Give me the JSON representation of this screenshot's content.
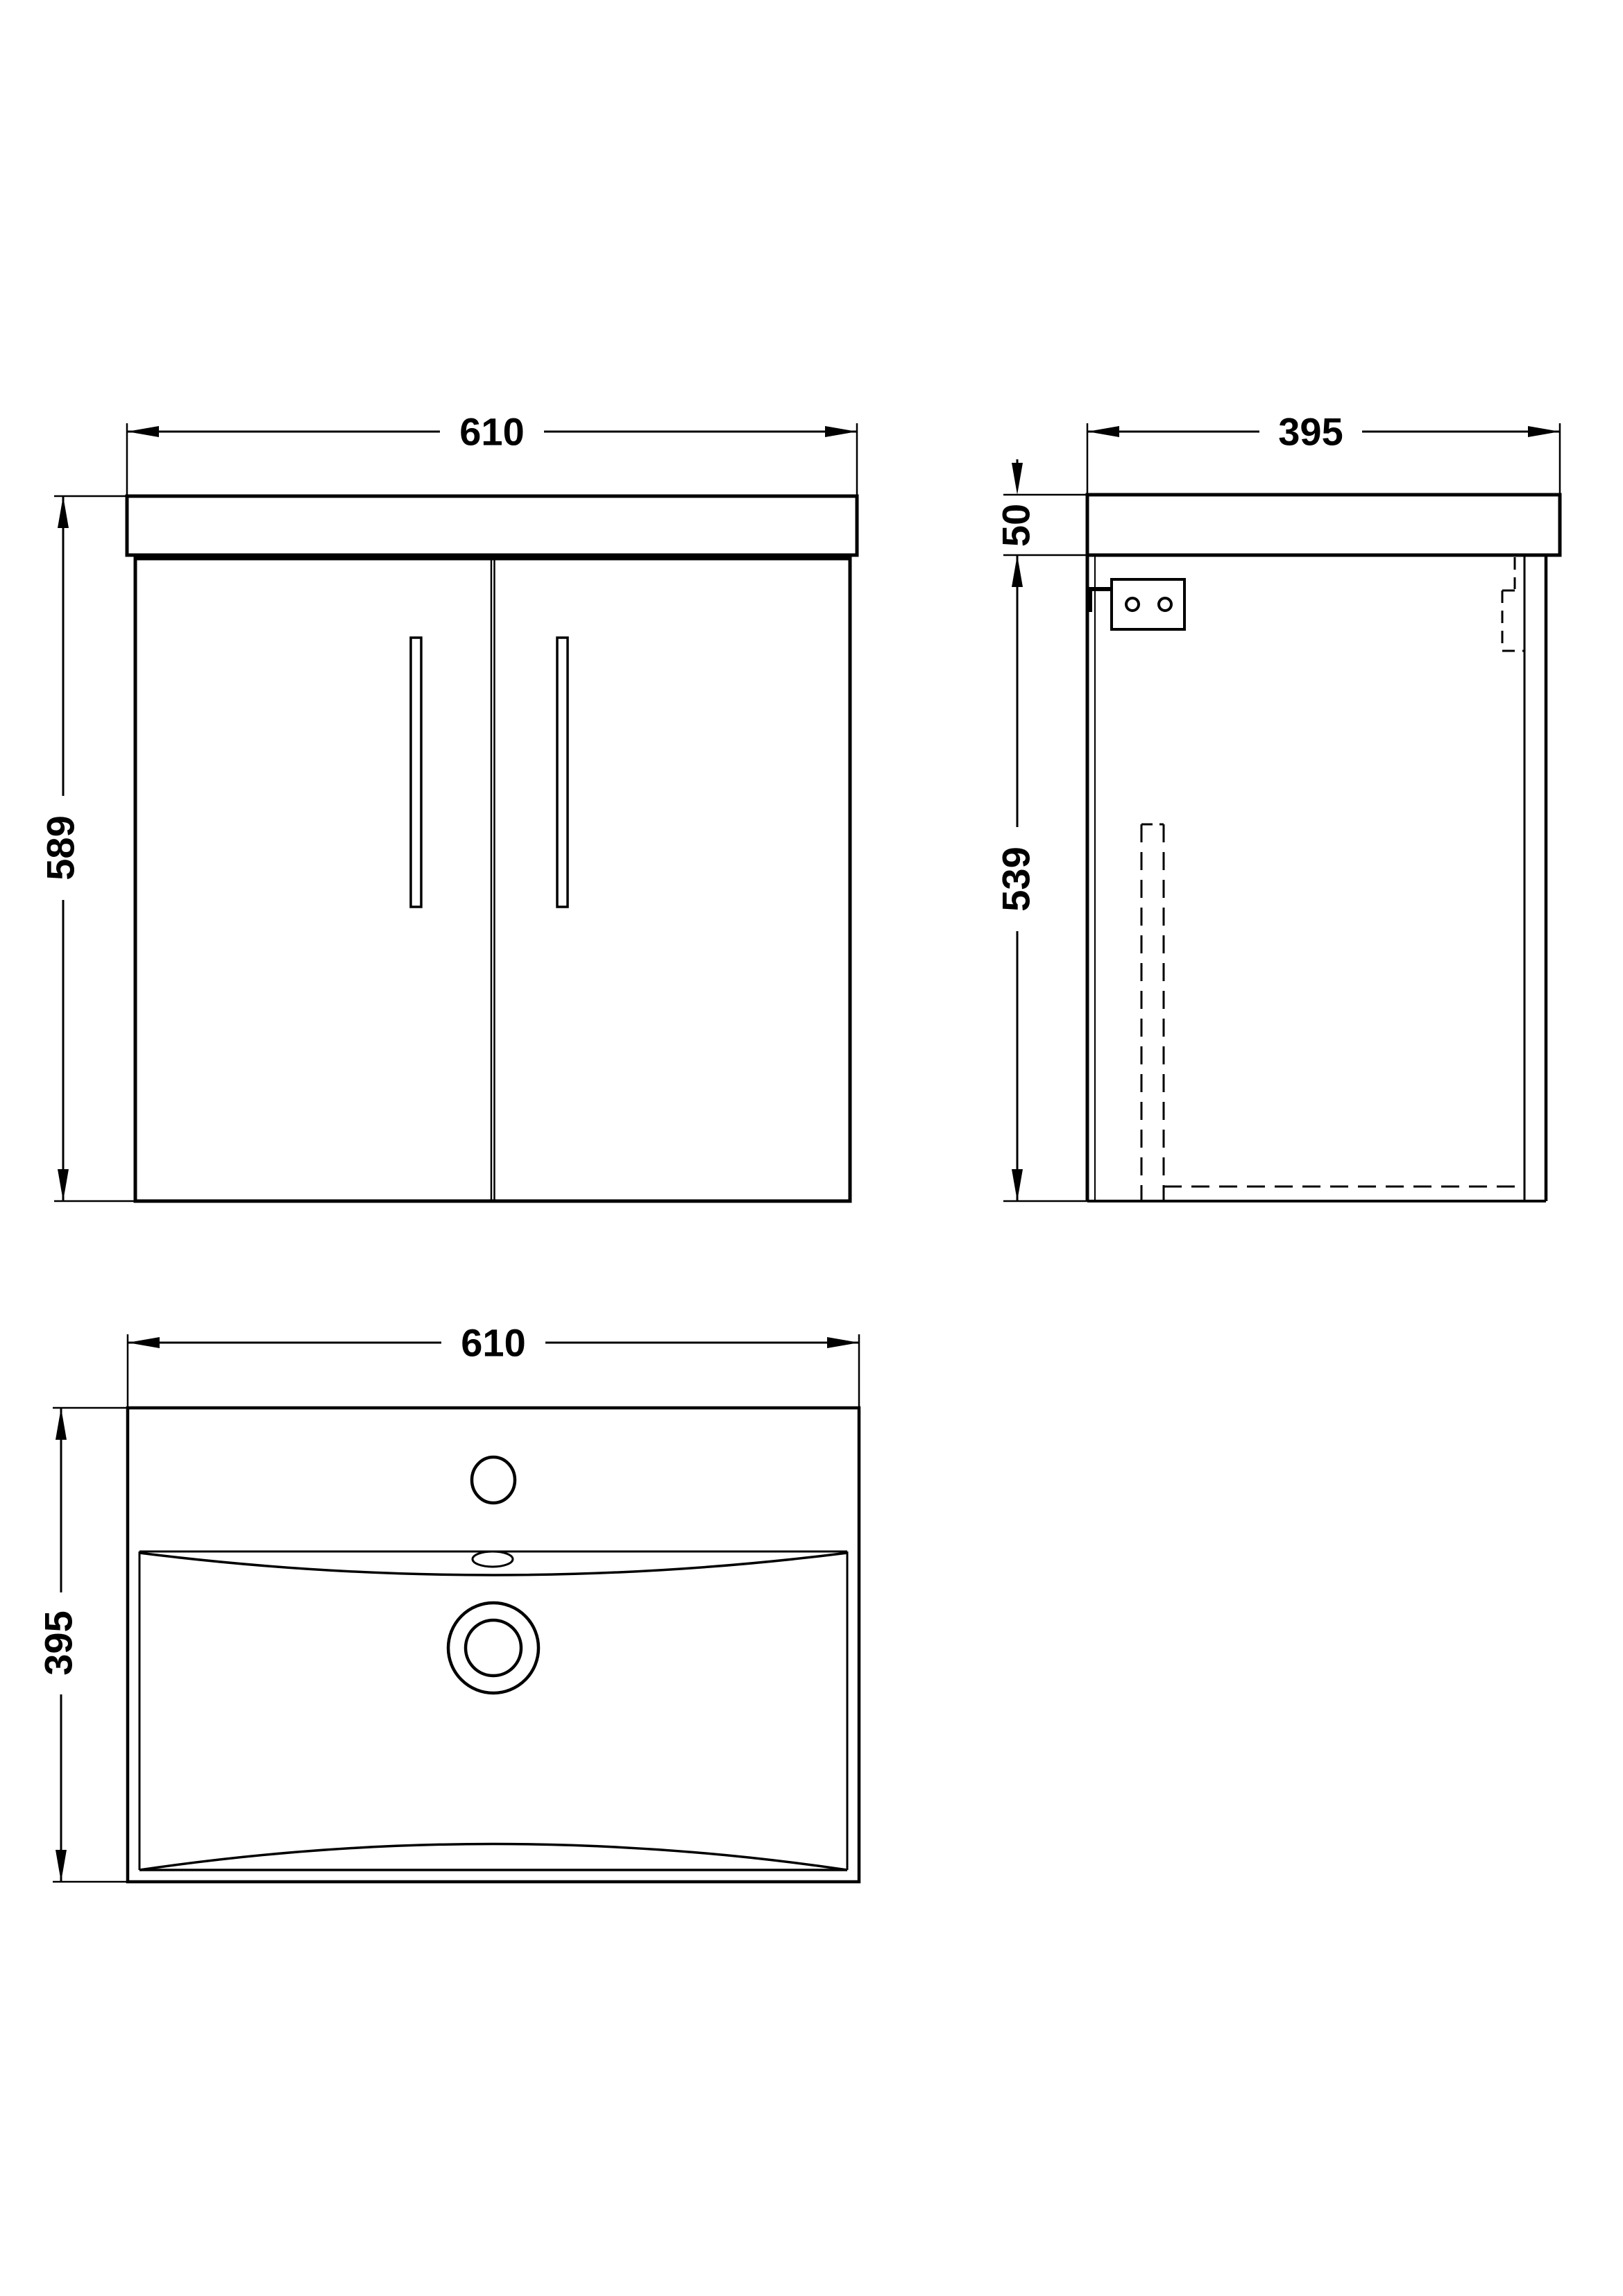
{
  "drawing": {
    "type": "technical-dimension-drawing",
    "subject": "wall-hung vanity unit with basin",
    "front_view": {
      "width_label": "610",
      "height_label": "589"
    },
    "side_view": {
      "depth_label": "395",
      "worktop_thickness_label": "50",
      "cabinet_height_label": "539"
    },
    "plan_view": {
      "width_label": "610",
      "depth_label": "395"
    }
  },
  "colors": {
    "line": "#000000",
    "background": "#ffffff"
  }
}
